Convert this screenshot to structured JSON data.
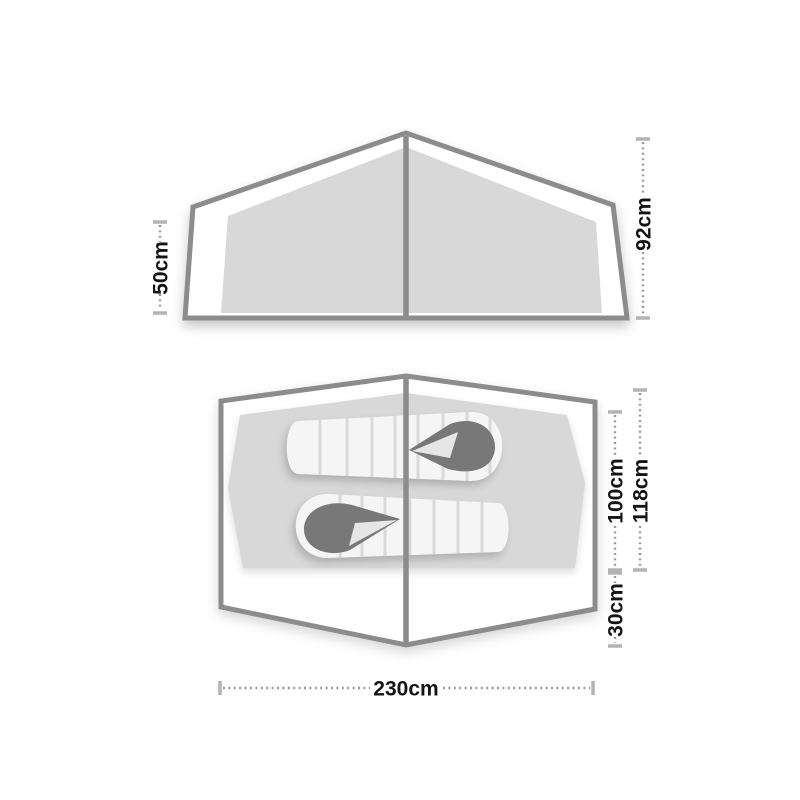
{
  "colors": {
    "background": "#ffffff",
    "outline": "#8c8c8c",
    "panel_fill": "#d8d8d8",
    "sleeping_bag_fill": "#f5f5f5",
    "sleeping_bag_baffle": "#d9d9d9",
    "hood_fill": "#787878",
    "dimension_dots": "#9a9a9a",
    "dimension_caps": "#b3b3b3",
    "label_text": "#141414"
  },
  "side_view": {
    "dimensions": {
      "side_height": {
        "label": "50cm"
      },
      "peak_height": {
        "label": "92cm"
      }
    }
  },
  "floor_plan": {
    "sleeping_pads_count": 2,
    "dimensions": {
      "inner_depth": {
        "label": "100cm"
      },
      "total_depth": {
        "label": "118cm"
      },
      "porch_depth": {
        "label": "30cm"
      },
      "width": {
        "label": "230cm"
      }
    }
  }
}
